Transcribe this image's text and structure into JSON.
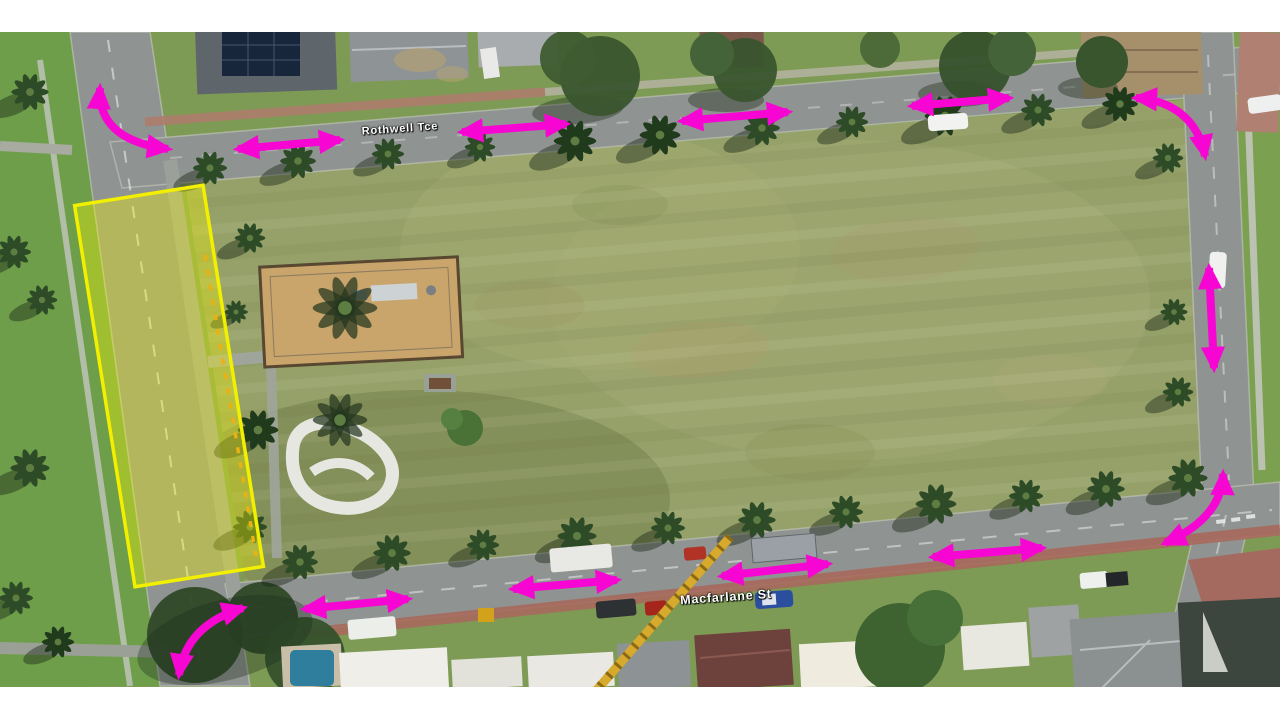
{
  "map": {
    "streets": [
      {
        "name": "Rothwell Tce",
        "x": 400,
        "y": 129,
        "rotation": -4,
        "font_size": 11
      },
      {
        "name": "Macfarlane St",
        "x": 726,
        "y": 597,
        "rotation": -4,
        "font_size": 12.5
      }
    ],
    "annotation": {
      "arrow_color": "#f705d2",
      "highlight": {
        "color": "#f8f800",
        "stroke_color": "#f2ef00",
        "fill_opacity": 0.35,
        "cx": 169,
        "cy": 386,
        "width": 130,
        "height": 386,
        "rotation": -9
      },
      "straight_arrows": [
        {
          "x1": 238,
          "y1": 149,
          "x2": 340,
          "y2": 140
        },
        {
          "x1": 462,
          "y1": 132,
          "x2": 566,
          "y2": 124
        },
        {
          "x1": 682,
          "y1": 121,
          "x2": 788,
          "y2": 112
        },
        {
          "x1": 912,
          "y1": 106,
          "x2": 1009,
          "y2": 98
        },
        {
          "x1": 1209,
          "y1": 268,
          "x2": 1214,
          "y2": 368
        },
        {
          "x1": 933,
          "y1": 557,
          "x2": 1042,
          "y2": 548
        },
        {
          "x1": 722,
          "y1": 576,
          "x2": 828,
          "y2": 564
        },
        {
          "x1": 513,
          "y1": 589,
          "x2": 617,
          "y2": 580
        },
        {
          "x1": 305,
          "y1": 609,
          "x2": 408,
          "y2": 599
        }
      ],
      "curved_arrows": [
        {
          "path": "M 100,88 Q 97,140 168,149"
        },
        {
          "path": "M 1136,98 C 1170,100 1198,118 1205,156"
        },
        {
          "path": "M 1223,474 Q 1222,518 1165,543"
        },
        {
          "path": "M 243,608 Q 186,625 179,675"
        }
      ]
    }
  }
}
